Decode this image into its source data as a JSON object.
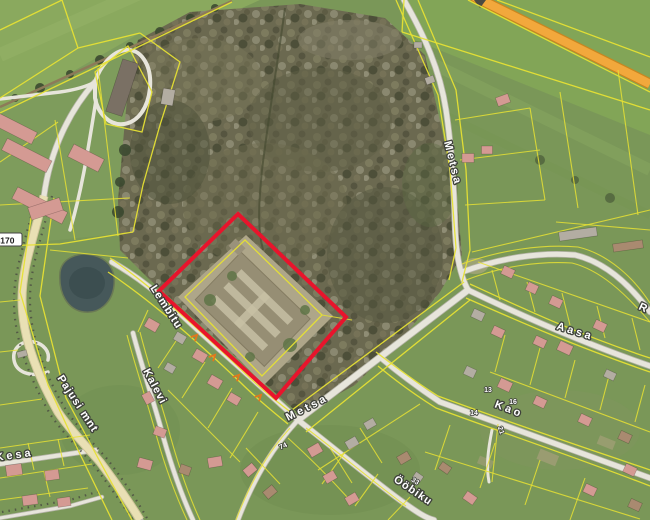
{
  "map": {
    "street_labels": [
      {
        "id": "lembitu",
        "text": "Lembitu"
      },
      {
        "id": "kalevi",
        "text": "Kalevi"
      },
      {
        "id": "metsa-sw",
        "text": "Metsa"
      },
      {
        "id": "metsa-north",
        "text": "Metsa"
      },
      {
        "id": "aasa",
        "text": "Aasa"
      },
      {
        "id": "kao",
        "text": "Kao"
      },
      {
        "id": "oobiku",
        "text": "Ööbiku"
      },
      {
        "id": "pajusi-mnt",
        "text": "Pajusi mnt"
      },
      {
        "id": "kesa",
        "text": "Kesa"
      },
      {
        "id": "edge-partial",
        "text": "R"
      }
    ],
    "road_number_badge": "4170",
    "house_numbers": [
      {
        "id": "hn-13",
        "text": "13"
      },
      {
        "id": "hn-16",
        "text": "16"
      },
      {
        "id": "hn-14",
        "text": "14"
      },
      {
        "id": "hn-21",
        "text": "21"
      },
      {
        "id": "hn-74",
        "text": "74"
      },
      {
        "id": "hn-33",
        "text": "33"
      }
    ],
    "selected_parcel": {
      "outline_color": "#e8142c"
    },
    "legend_colors": {
      "cadastral_boundary": "#e6e034",
      "major_road_overlay": "#f0a339",
      "survey_mark": "#e2771c"
    }
  }
}
